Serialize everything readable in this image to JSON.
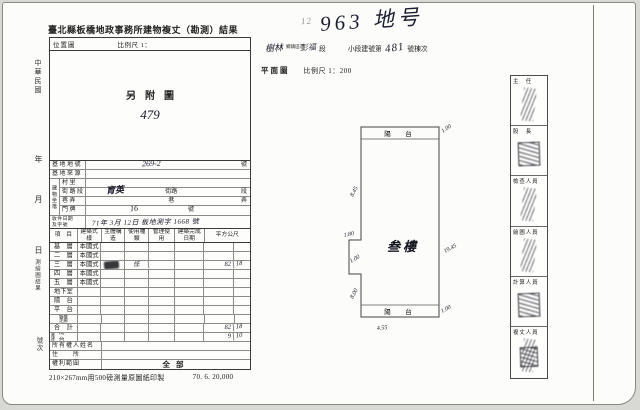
{
  "doc": {
    "title": "臺北縣板橋地政事務所建物複丈（勘測）結果",
    "print_note": "210×267mm用500磅測量原圖紙印製",
    "print_code": "70. 6. 20,000"
  },
  "margin": {
    "era": "中華民國",
    "year": "年",
    "month": "月",
    "day": "日",
    "result": "測繪圖結果",
    "number": "號次"
  },
  "map_box": {
    "label": "位置圖",
    "scale": "比例尺 1：",
    "note": "另附圖",
    "hand_number": "479"
  },
  "info": {
    "lot_label": "基地地號",
    "lot_value": "269-2",
    "lot_unit": "號",
    "source_label": "基地來源",
    "loc_label": "建物坐落",
    "village_label": "村里",
    "street_label": "街路段",
    "street_value": "育英",
    "street_mid": "街路",
    "street_unit": "段",
    "lane_label": "巷弄",
    "lane_mid": "巷",
    "lane_unit": "弄",
    "door_label": "門牌",
    "door_value": "16",
    "door_unit": "號",
    "receipt_label1": "收件日期",
    "receipt_label2": "及字號",
    "receipt_value": "71年 3月 12日 板地測字 1668 號"
  },
  "table": {
    "headers": [
      "項　目",
      "建築式樣",
      "主體構造",
      "使用種類",
      "管理使用",
      "建築完成日期",
      "平方公尺"
    ],
    "rows": [
      {
        "label": "基　層",
        "style": "本國式"
      },
      {
        "label": "二　層",
        "style": "本國式"
      },
      {
        "label": "三　層",
        "style": "本國式",
        "use": "住",
        "m2_int": "82",
        "m2_dec": "18"
      },
      {
        "label": "四　層",
        "style": "本國式"
      },
      {
        "label": "五　層",
        "style": "本國式"
      },
      {
        "label": "地下室"
      },
      {
        "label": "陽　台"
      },
      {
        "label": "平　台"
      },
      {
        "label": "騎樓走廊"
      },
      {
        "label": "合　計",
        "m2_int": "82",
        "m2_dec": "18"
      },
      {
        "label": "附屬建物",
        "label2": "陽　台",
        "m2_int": "9",
        "m2_dec": "10"
      }
    ],
    "owner_label": "所有權人姓名",
    "address_label": "住　　所",
    "scope_label": "權利範圍",
    "scope_value": "全部"
  },
  "plan": {
    "hand_prefix": "12",
    "hand_title": "963 地号",
    "line": {
      "hw_city": "樹林",
      "township": "鄉鎮區市",
      "hw_section": "彭福",
      "section_unit": "段",
      "sub_label": "小段建號第",
      "hw_number": "481",
      "unit": "號棟次"
    },
    "title": "平面圖",
    "scale": "比例尺 1：200",
    "balcony_top": "陽　台",
    "balcony_bottom": "陽　台",
    "room_label": "叁樓",
    "dims": {
      "top_right": "1.00",
      "left_upper": "8.45",
      "notch_top": "1.80",
      "notch_left": "1.00",
      "right_side": "19.45",
      "left_lower": "8.00",
      "bottom_right": "1.00",
      "bottom_width": "4.55"
    }
  },
  "signatures": {
    "cells": [
      {
        "label": "主　任"
      },
      {
        "label": "股　長"
      },
      {
        "label": "檢查人員"
      },
      {
        "label": "繪圖人員"
      },
      {
        "label": "計算人員"
      },
      {
        "label": "複丈人員"
      }
    ]
  }
}
